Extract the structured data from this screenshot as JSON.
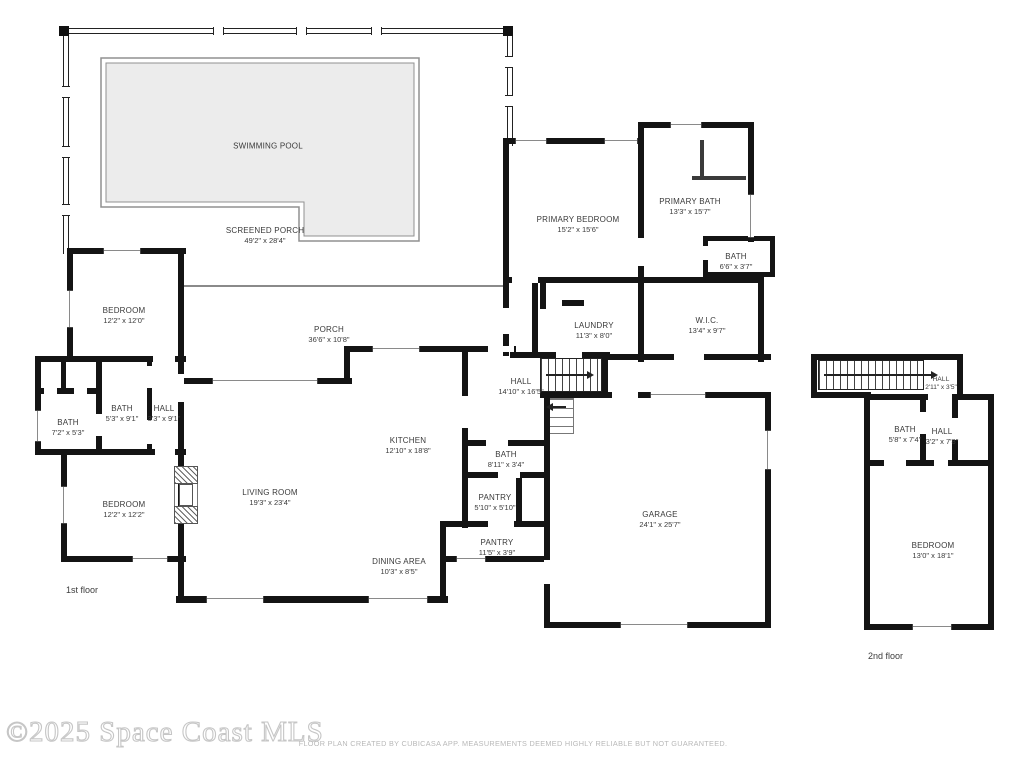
{
  "footer": {
    "watermark": "©2025 Space Coast MLS",
    "disclaimer": "FLOOR PLAN CREATED BY CUBICASA APP. MEASUREMENTS DEEMED HIGHLY RELIABLE BUT NOT GUARANTEED."
  },
  "floors": {
    "first": "1st floor",
    "second": "2nd floor"
  },
  "colors": {
    "wall": "#141414",
    "pool_fill": "#ececec",
    "pool_line": "#909090",
    "label": "#3a3a3a"
  },
  "rooms": {
    "swimming_pool": {
      "name": "SWIMMING POOL",
      "dims": ""
    },
    "screened_porch": {
      "name": "SCREENED PORCH",
      "dims": "49'2\" x 28'4\""
    },
    "porch": {
      "name": "PORCH",
      "dims": "36'6\" x 10'8\""
    },
    "primary_bedroom": {
      "name": "PRIMARY BEDROOM",
      "dims": "15'2\" x 15'6\""
    },
    "primary_bath": {
      "name": "PRIMARY BATH",
      "dims": "13'3\" x 15'7\""
    },
    "bath_primary_wc": {
      "name": "BATH",
      "dims": "6'6\" x 3'7\""
    },
    "laundry": {
      "name": "LAUNDRY",
      "dims": "11'3\" x 8'0\""
    },
    "wic": {
      "name": "W.I.C.",
      "dims": "13'4\" x 9'7\""
    },
    "hall_main": {
      "name": "HALL",
      "dims": "14'10\" x 16'5\""
    },
    "bedroom_nw": {
      "name": "BEDROOM",
      "dims": "12'2\" x 12'0\""
    },
    "bath_53": {
      "name": "BATH",
      "dims": "5'3\" x 9'1\""
    },
    "hall_west": {
      "name": "HALL",
      "dims": "3'3\" x 9'1\""
    },
    "bath_72": {
      "name": "BATH",
      "dims": "7'2\" x 5'3\""
    },
    "bedroom_sw": {
      "name": "BEDROOM",
      "dims": "12'2\" x 12'2\""
    },
    "kitchen": {
      "name": "KITCHEN",
      "dims": "12'10\" x 18'8\""
    },
    "living_room": {
      "name": "LIVING ROOM",
      "dims": "19'3\" x 23'4\""
    },
    "bath_hall": {
      "name": "BATH",
      "dims": "8'11\" x 3'4\""
    },
    "pantry_small": {
      "name": "PANTRY",
      "dims": "5'10\" x 5'10\""
    },
    "pantry_long": {
      "name": "PANTRY",
      "dims": "11'5\" x 3'9\""
    },
    "dining": {
      "name": "DINING AREA",
      "dims": "10'3\" x 8'5\""
    },
    "garage": {
      "name": "GARAGE",
      "dims": "24'1\" x 25'7\""
    },
    "hall_up_small": {
      "name": "HALL",
      "dims": "2'11\" x 3'5\""
    },
    "bath_up": {
      "name": "BATH",
      "dims": "5'8\" x 7'4\""
    },
    "hall_up": {
      "name": "HALL",
      "dims": "3'2\" x 7'8\""
    },
    "bedroom_up": {
      "name": "BEDROOM",
      "dims": "13'0\" x 18'1\""
    }
  }
}
